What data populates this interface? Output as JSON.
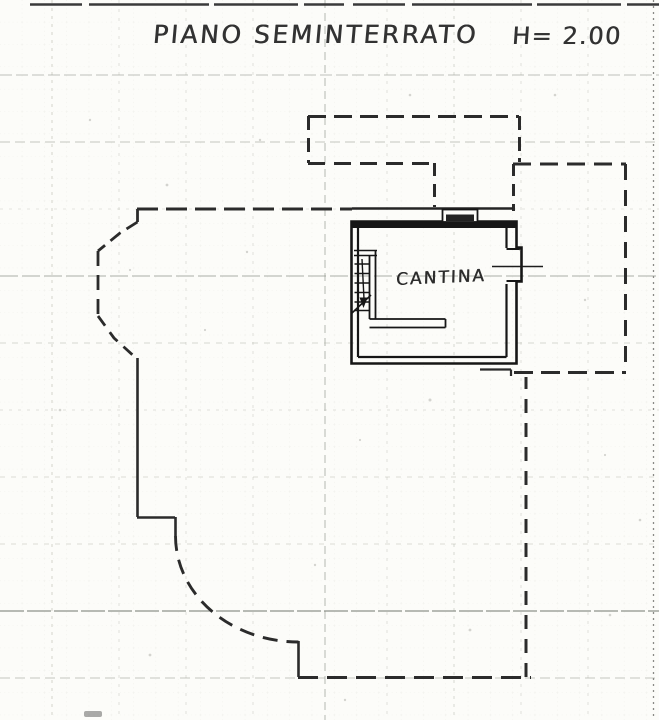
{
  "sheet": {
    "title": "PIANO SEMINTERRATO",
    "height_annotation": "H= 2.00",
    "rooms": [
      {
        "name": "CANTINA"
      }
    ]
  },
  "colors": {
    "paper": "#fcfcf9",
    "ink": "#1d1d1d",
    "dashed_outline": "#2b2b2b",
    "grid": "#a9aca0"
  }
}
